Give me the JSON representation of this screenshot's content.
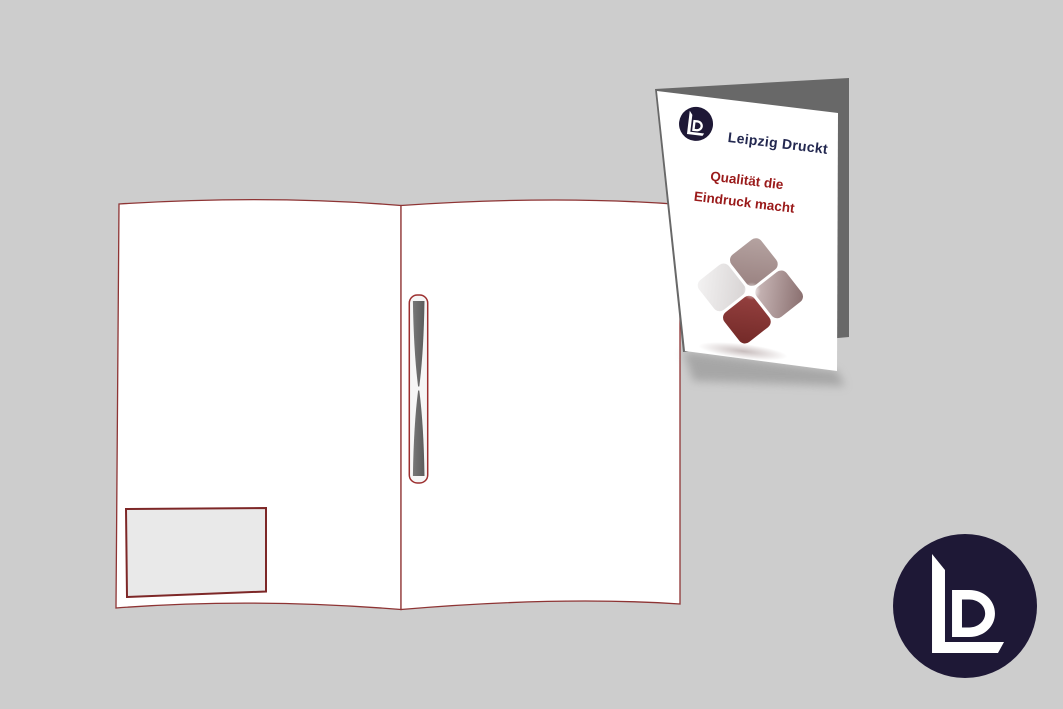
{
  "scene": {
    "background_color": "#cdcdcd"
  },
  "open_folder": {
    "page_color": "#ffffff",
    "outline_color": "#8e3434",
    "business_card_slot": {
      "fill": "#e9e9e9",
      "border_color": "#7d2727"
    },
    "pen_slot": {
      "fill": "#f6f6f6",
      "border_color": "#9c2f2f",
      "insert_color": "#686868"
    }
  },
  "closed_folder": {
    "front_color": "#ffffff",
    "back_color": "#686868",
    "brand_name": "Leipzig Druckt",
    "brand_color": "#232850",
    "tagline_line1": "Qualität die",
    "tagline_line2": "Eindruck macht",
    "tagline_color": "#9a1a1a",
    "logo_badge": {
      "circle_color": "#1e1836",
      "monogram": "LD",
      "monogram_color": "#ffffff"
    },
    "diamond_emblem": {
      "left_color": "#eeecec",
      "top_color": "#a7918f",
      "right_color": "#a18686",
      "bottom_color": "#8a3533"
    }
  },
  "corner_logo": {
    "circle_color": "#1e1836",
    "monogram": "LD",
    "monogram_color": "#ffffff"
  }
}
